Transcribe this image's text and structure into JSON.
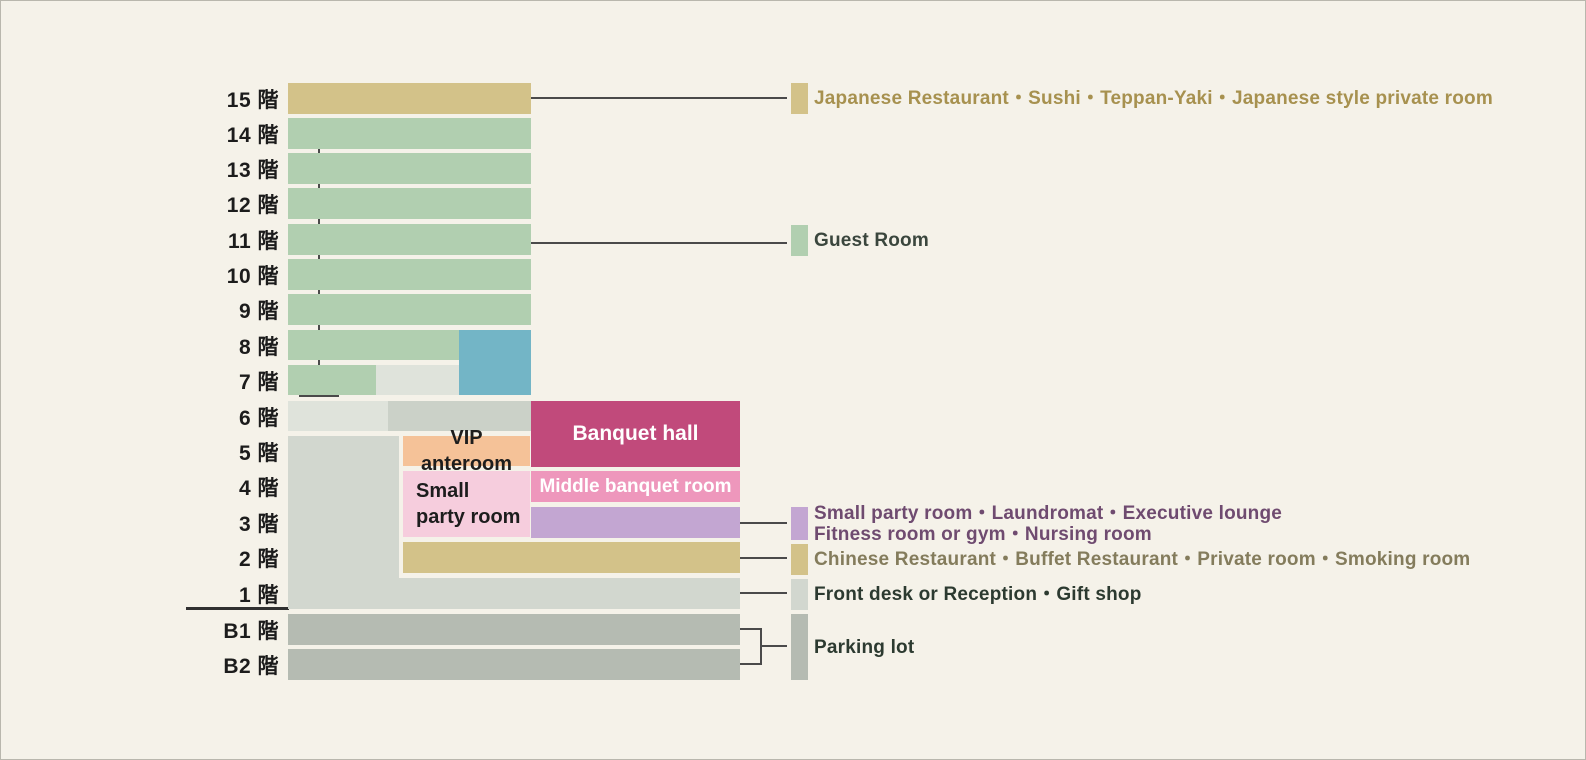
{
  "diagram_title": "Hotel floor guide",
  "colors": {
    "background": "#f5f2e9",
    "line": "#4a4a4a",
    "ground": "#303030",
    "floor_label_text": "#1c1c1c",
    "tan": "#d3c289",
    "green": "#b1cfb0",
    "blue": "#73b5c6",
    "magenta": "#c14a7b",
    "pink_mid": "#ee97bc",
    "pink_light": "#f6cddd",
    "orange": "#f5c298",
    "purple": "#c3a6d2",
    "gray_lighter": "#dfe3db",
    "gray_mid": "#cbd1c8",
    "gray_light": "#d2d7cf",
    "gray_dark": "#b5bbb2",
    "text_gold": "#a7914f",
    "text_green_dark": "#3a463d",
    "text_purple": "#6f4b70",
    "text_olive": "#847c5c",
    "text_dark": "#2c3a30",
    "block_label_dark": "#1d1d1d",
    "block_label_light": "#ffffff"
  },
  "floor_labels": [
    {
      "label": "15 階",
      "y": 82
    },
    {
      "label": "14 階",
      "y": 117
    },
    {
      "label": "13 階",
      "y": 152
    },
    {
      "label": "12 階",
      "y": 187
    },
    {
      "label": "11 階",
      "y": 223
    },
    {
      "label": "10 階",
      "y": 258
    },
    {
      "label": "9 階",
      "y": 293
    },
    {
      "label": "8 階",
      "y": 329
    },
    {
      "label": "7 階",
      "y": 364
    },
    {
      "label": "6 階",
      "y": 400
    },
    {
      "label": "5 階",
      "y": 435
    },
    {
      "label": "4 階",
      "y": 470
    },
    {
      "label": "3 階",
      "y": 506
    },
    {
      "label": "2 階",
      "y": 541
    },
    {
      "label": "1 階",
      "y": 577
    },
    {
      "label": "B1 階",
      "y": 613
    },
    {
      "label": "B2 階",
      "y": 648
    }
  ],
  "blocks": [
    {
      "name": "floor15-restaurant-bar",
      "x": 287,
      "y": 82,
      "w": 243,
      "h": 31,
      "color": "tan"
    },
    {
      "name": "floor14-guestroom-bar",
      "x": 287,
      "y": 117,
      "w": 243,
      "h": 31,
      "color": "green"
    },
    {
      "name": "floor13-guestroom-bar",
      "x": 287,
      "y": 152,
      "w": 243,
      "h": 31,
      "color": "green"
    },
    {
      "name": "floor12-guestroom-bar",
      "x": 287,
      "y": 187,
      "w": 243,
      "h": 31,
      "color": "green"
    },
    {
      "name": "floor11-guestroom-bar",
      "x": 287,
      "y": 223,
      "w": 243,
      "h": 31,
      "color": "green"
    },
    {
      "name": "floor10-guestroom-bar",
      "x": 287,
      "y": 258,
      "w": 243,
      "h": 31,
      "color": "green"
    },
    {
      "name": "floor9-guestroom-bar",
      "x": 287,
      "y": 293,
      "w": 243,
      "h": 31,
      "color": "green"
    },
    {
      "name": "floor8-guestroom-bar",
      "x": 287,
      "y": 329,
      "w": 171,
      "h": 30,
      "color": "green"
    },
    {
      "name": "floor8-7-blue-block",
      "x": 458,
      "y": 329,
      "w": 72,
      "h": 65,
      "color": "blue"
    },
    {
      "name": "floor7-guestroom-bar",
      "x": 287,
      "y": 364,
      "w": 88,
      "h": 30,
      "color": "green"
    },
    {
      "name": "floor7-gray-block",
      "x": 375,
      "y": 364,
      "w": 83,
      "h": 30,
      "color": "gray_lighter"
    },
    {
      "name": "floor6-gray-left-block",
      "x": 287,
      "y": 400,
      "w": 100,
      "h": 30,
      "color": "gray_lighter"
    },
    {
      "name": "floor6-gray-right-block",
      "x": 387,
      "y": 400,
      "w": 143,
      "h": 30,
      "color": "gray_mid"
    },
    {
      "name": "banquet-hall-block",
      "x": 530,
      "y": 400,
      "w": 209,
      "h": 66,
      "color": "magenta",
      "label": "Banquet hall",
      "label_color": "block_label_light",
      "align": "center",
      "font_size": 21
    },
    {
      "name": "lower-floors-gray-block",
      "x": 287,
      "y": 435,
      "w": 111,
      "h": 173,
      "color": "gray_light"
    },
    {
      "name": "vip-anteroom-block",
      "x": 402,
      "y": 435,
      "w": 127,
      "h": 30,
      "color": "orange",
      "label": "VIP anteroom",
      "label_color": "block_label_dark",
      "align": "center",
      "font_size": 20
    },
    {
      "name": "small-party-room-block",
      "x": 402,
      "y": 470,
      "w": 127,
      "h": 66,
      "color": "pink_light",
      "label": "Small\nparty room",
      "label_color": "block_label_dark",
      "align": "left",
      "font_size": 20
    },
    {
      "name": "middle-banquet-room-block",
      "x": 530,
      "y": 470,
      "w": 209,
      "h": 31,
      "color": "pink_mid",
      "label": "Middle banquet room",
      "label_color": "block_label_light",
      "align": "center",
      "font_size": 19
    },
    {
      "name": "floor3-purple-block",
      "x": 530,
      "y": 506,
      "w": 209,
      "h": 31,
      "color": "purple"
    },
    {
      "name": "floor2-restaurant-bar",
      "x": 402,
      "y": 541,
      "w": 337,
      "h": 31,
      "color": "tan"
    },
    {
      "name": "floor1-front-desk-bar",
      "x": 287,
      "y": 577,
      "w": 452,
      "h": 31,
      "color": "gray_light"
    },
    {
      "name": "floorB1-parking-bar",
      "x": 287,
      "y": 613,
      "w": 452,
      "h": 31,
      "color": "gray_dark"
    },
    {
      "name": "floorB2-parking-bar",
      "x": 287,
      "y": 648,
      "w": 452,
      "h": 31,
      "color": "gray_dark"
    }
  ],
  "lines": [
    {
      "name": "leader-line-floor15",
      "x": 530,
      "y": 96,
      "w": 256,
      "h": 2,
      "color": "line"
    },
    {
      "name": "guestroom-bracket-top-cap",
      "x": 298,
      "y": 118,
      "w": 40,
      "h": 2,
      "color": "line"
    },
    {
      "name": "guestroom-bracket-vertical",
      "x": 317,
      "y": 118,
      "w": 2,
      "h": 278,
      "color": "line"
    },
    {
      "name": "guestroom-bracket-bottom-cap",
      "x": 298,
      "y": 394,
      "w": 40,
      "h": 2,
      "color": "line"
    },
    {
      "name": "leader-line-guest-room",
      "x": 318,
      "y": 241,
      "w": 468,
      "h": 2,
      "color": "line"
    },
    {
      "name": "leader-line-floor3",
      "x": 739,
      "y": 521,
      "w": 47,
      "h": 2,
      "color": "line"
    },
    {
      "name": "leader-line-floor2",
      "x": 739,
      "y": 556,
      "w": 47,
      "h": 2,
      "color": "line"
    },
    {
      "name": "leader-line-floor1",
      "x": 739,
      "y": 591,
      "w": 47,
      "h": 2,
      "color": "line"
    },
    {
      "name": "parking-b1-connector",
      "x": 739,
      "y": 627,
      "w": 22,
      "h": 2,
      "color": "line"
    },
    {
      "name": "parking-b2-connector",
      "x": 739,
      "y": 662,
      "w": 22,
      "h": 2,
      "color": "line"
    },
    {
      "name": "parking-bracket-vertical",
      "x": 759,
      "y": 627,
      "w": 2,
      "h": 37,
      "color": "line"
    },
    {
      "name": "parking-leader",
      "x": 761,
      "y": 644,
      "w": 25,
      "h": 2,
      "color": "line"
    },
    {
      "name": "ground-line",
      "x": 185,
      "y": 606,
      "w": 103,
      "h": 3,
      "color": "ground"
    }
  ],
  "legend": [
    {
      "name": "legend-japanese-restaurant",
      "swatch": {
        "x": 790,
        "y": 82,
        "w": 17,
        "h": 31,
        "color": "tan"
      },
      "text": {
        "x": 813,
        "y": 82,
        "h": 31,
        "color": "text_gold"
      },
      "lines": [
        "Japanese Restaurant・Sushi・Teppan-Yaki・Japanese style private room"
      ]
    },
    {
      "name": "legend-guest-room",
      "swatch": {
        "x": 790,
        "y": 224,
        "w": 17,
        "h": 31,
        "color": "green"
      },
      "text": {
        "x": 813,
        "y": 224,
        "h": 31,
        "color": "text_green_dark"
      },
      "lines": [
        "Guest Room"
      ]
    },
    {
      "name": "legend-small-party-room",
      "swatch": {
        "x": 790,
        "y": 506,
        "w": 17,
        "h": 33,
        "color": "purple"
      },
      "text": {
        "x": 813,
        "y": 501,
        "h": 44,
        "color": "text_purple"
      },
      "lines": [
        "Small party room・Laundromat・Executive lounge",
        "Fitness room or gym・Nursing room"
      ]
    },
    {
      "name": "legend-chinese-restaurant",
      "swatch": {
        "x": 790,
        "y": 543,
        "w": 17,
        "h": 31,
        "color": "tan"
      },
      "text": {
        "x": 813,
        "y": 543,
        "h": 31,
        "color": "text_olive"
      },
      "lines": [
        "Chinese Restaurant・Buffet Restaurant・Private room・Smoking room"
      ]
    },
    {
      "name": "legend-front-desk",
      "swatch": {
        "x": 790,
        "y": 578,
        "w": 17,
        "h": 31,
        "color": "gray_light"
      },
      "text": {
        "x": 813,
        "y": 578,
        "h": 31,
        "color": "text_dark"
      },
      "lines": [
        "Front desk or Reception・Gift shop"
      ]
    },
    {
      "name": "legend-parking-lot",
      "swatch": {
        "x": 790,
        "y": 613,
        "w": 17,
        "h": 66,
        "color": "gray_dark"
      },
      "text": {
        "x": 813,
        "y": 613,
        "h": 66,
        "color": "text_dark"
      },
      "lines": [
        "Parking lot"
      ]
    }
  ]
}
